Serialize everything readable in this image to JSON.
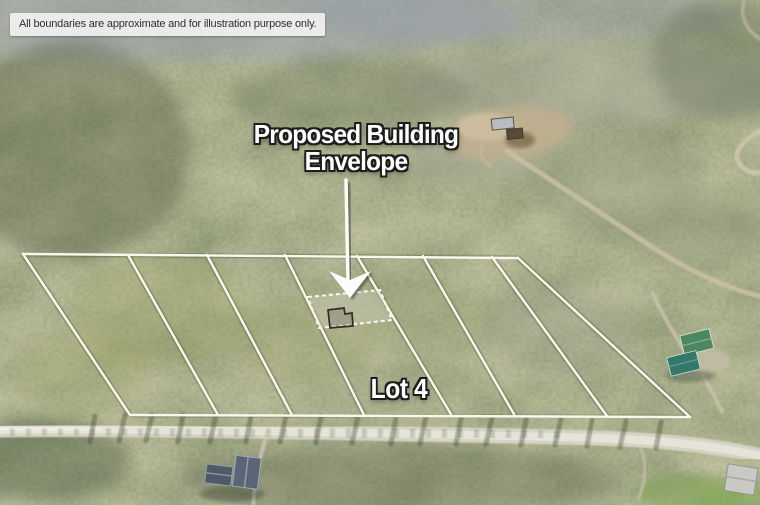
{
  "page": {
    "width": 760,
    "height": 505,
    "kind": "aerial-drone-photo-of-wooded-subdivision"
  },
  "disclaimer": {
    "text": "All boundaries are approximate and for illustration purpose only."
  },
  "labels": {
    "title_line1": "Proposed Building",
    "title_line2": "Envelope",
    "lot": "Lot 4"
  },
  "colors": {
    "line": "#faf7ec",
    "line_shadow": "rgba(35,45,30,0.38)",
    "text": "#ffffff",
    "text_outline": "#1d1d1b",
    "envelope_fill": "rgba(214,209,196,0.38)",
    "footprint_stroke": "#2e2d2a",
    "arrow": "#fcfcf9",
    "road": "#d7d3c5",
    "forest_base": "#66704e"
  },
  "boundary_lines": [
    {
      "name": "top-boundary",
      "points": [
        [
          23,
          254
        ],
        [
          518,
          258
        ]
      ]
    },
    {
      "name": "left-boundary",
      "points": [
        [
          23,
          254
        ],
        [
          130,
          415
        ]
      ]
    },
    {
      "name": "bottom-boundary",
      "points": [
        [
          130,
          415
        ],
        [
          690,
          417
        ]
      ]
    },
    {
      "name": "right-boundary",
      "points": [
        [
          518,
          258
        ],
        [
          690,
          417
        ]
      ]
    },
    {
      "name": "lot-line-1",
      "points": [
        [
          128,
          255
        ],
        [
          218,
          415
        ]
      ]
    },
    {
      "name": "lot-line-2",
      "points": [
        [
          207,
          255
        ],
        [
          292,
          415
        ]
      ]
    },
    {
      "name": "lot-line-3",
      "points": [
        [
          285,
          255
        ],
        [
          364,
          415
        ]
      ]
    },
    {
      "name": "lot-line-4",
      "points": [
        [
          357,
          256
        ],
        [
          452,
          416
        ]
      ]
    },
    {
      "name": "lot-line-5",
      "points": [
        [
          423,
          256
        ],
        [
          515,
          416
        ]
      ]
    },
    {
      "name": "lot-line-6",
      "points": [
        [
          492,
          257
        ],
        [
          607,
          416
        ]
      ]
    }
  ],
  "building_envelope": {
    "polygon": [
      [
        308,
        297
      ],
      [
        380,
        290
      ],
      [
        392,
        320
      ],
      [
        319,
        328
      ]
    ],
    "footprint": [
      [
        328,
        310
      ],
      [
        344,
        308
      ],
      [
        345,
        314
      ],
      [
        352,
        313
      ],
      [
        353,
        326
      ],
      [
        330,
        328
      ]
    ]
  },
  "arrow": {
    "shaft": [
      [
        346,
        180
      ],
      [
        348,
        282
      ]
    ],
    "head": [
      [
        350,
        298
      ],
      [
        329,
        271
      ],
      [
        350,
        280
      ],
      [
        371,
        271
      ]
    ]
  }
}
